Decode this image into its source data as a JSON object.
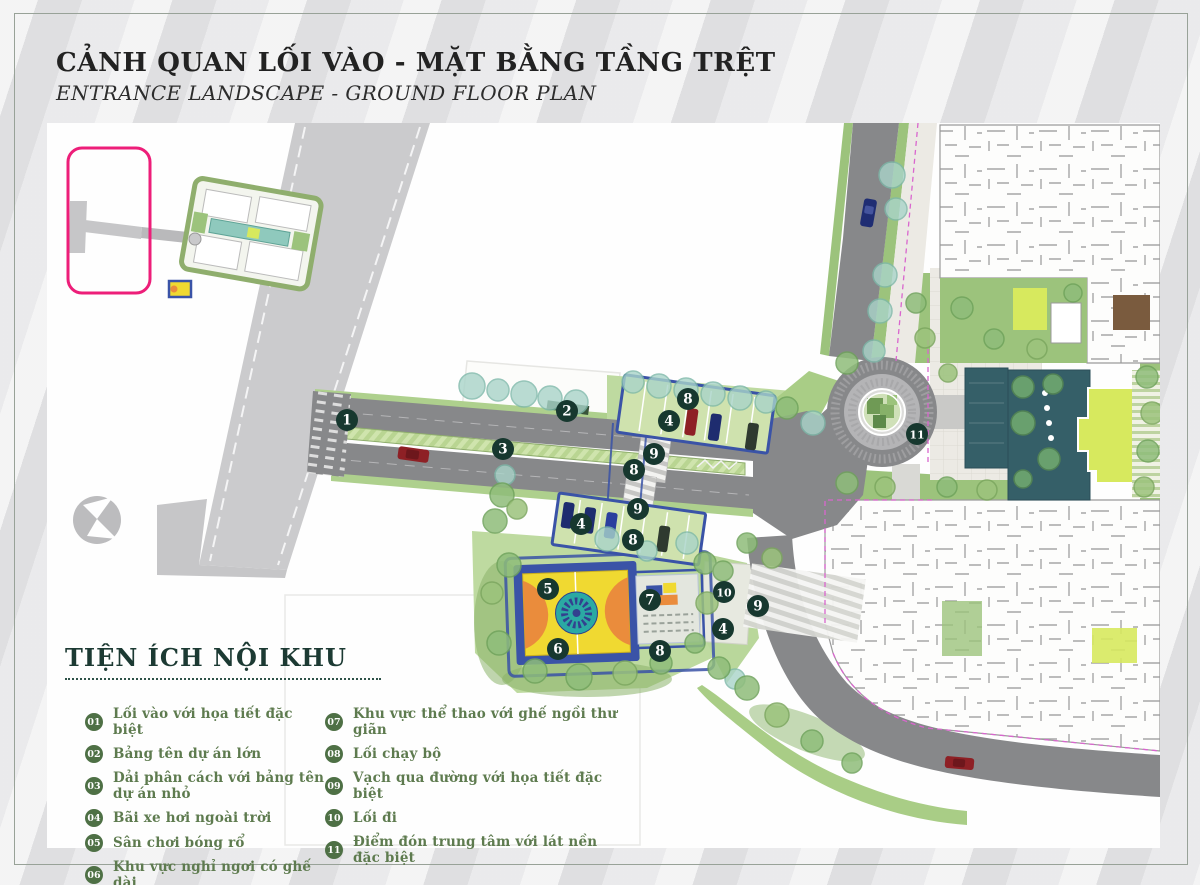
{
  "header": {
    "title": "CẢNH QUAN LỐI VÀO - MẶT BẰNG TẦNG TRỆT",
    "subtitle": "ENTRANCE LANDSCAPE - GROUND FLOOR PLAN"
  },
  "legend": {
    "heading": "TIỆN ÍCH NỘI KHU",
    "columns": [
      [
        {
          "num": "01",
          "label": "Lối vào với họa tiết đặc biệt"
        },
        {
          "num": "02",
          "label": "Bảng tên dự án lớn"
        },
        {
          "num": "03",
          "label": "Dải phân cách với bảng tên dự án nhỏ"
        },
        {
          "num": "04",
          "label": "Bãi xe hơi ngoài trời"
        },
        {
          "num": "05",
          "label": "Sân chơi bóng rổ"
        },
        {
          "num": "06",
          "label": "Khu vực nghỉ ngơi có ghế dài"
        }
      ],
      [
        {
          "num": "07",
          "label": "Khu vực thể thao với ghế ngồi thư giãn"
        },
        {
          "num": "08",
          "label": "Lối chạy bộ"
        },
        {
          "num": "09",
          "label": "Vạch qua đường với họa tiết đặc biệt"
        },
        {
          "num": "10",
          "label": "Lối đi"
        },
        {
          "num": "11",
          "label": "Điểm đón trung tâm với lát nền đặc biệt"
        }
      ]
    ]
  },
  "plan": {
    "markers": [
      {
        "n": "1",
        "x": 300,
        "y": 297
      },
      {
        "n": "2",
        "x": 520,
        "y": 288
      },
      {
        "n": "3",
        "x": 456,
        "y": 326
      },
      {
        "n": "8",
        "x": 641,
        "y": 276
      },
      {
        "n": "4",
        "x": 622,
        "y": 298
      },
      {
        "n": "9",
        "x": 607,
        "y": 331
      },
      {
        "n": "8",
        "x": 587,
        "y": 347
      },
      {
        "n": "9",
        "x": 591,
        "y": 386
      },
      {
        "n": "4",
        "x": 534,
        "y": 401
      },
      {
        "n": "8",
        "x": 586,
        "y": 417
      },
      {
        "n": "5",
        "x": 501,
        "y": 466
      },
      {
        "n": "7",
        "x": 603,
        "y": 477
      },
      {
        "n": "10",
        "x": 677,
        "y": 469
      },
      {
        "n": "4",
        "x": 676,
        "y": 506
      },
      {
        "n": "9",
        "x": 711,
        "y": 483
      },
      {
        "n": "6",
        "x": 511,
        "y": 526
      },
      {
        "n": "8",
        "x": 613,
        "y": 528
      },
      {
        "n": "11",
        "x": 870,
        "y": 311
      }
    ]
  },
  "colors": {
    "accent_pink": "#ed1e79",
    "marker": "#17382f",
    "legend_circle": "#4e7045",
    "legend_text": "#5e7b4f",
    "heading": "#1c3a33",
    "court_yellow": "#f0d931",
    "court_orange": "#ea8c3c",
    "court_teal": "#2ba9a3",
    "track_blue": "#3a53a7",
    "water": "#355f68",
    "lawn": "#d7e95e",
    "road": "#87888a"
  }
}
